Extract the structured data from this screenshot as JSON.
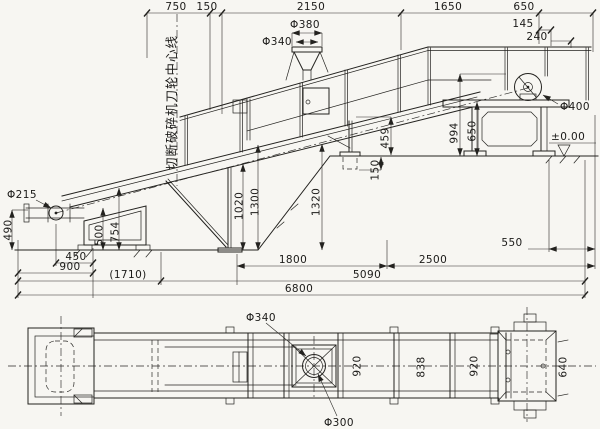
{
  "canvas": {
    "width": 600,
    "height": 429,
    "background": "#f7f6f2",
    "ink": "#23221f"
  },
  "elevation": {
    "note_crusher_centerline": "切断破碎机刀轮中心线",
    "top": {
      "d750": "750",
      "d150": "150",
      "d2150": "2150",
      "d1650": "1650",
      "d650": "650",
      "d145": "145",
      "d240": "240",
      "phi380": "Φ380",
      "phi340": "Φ340"
    },
    "right": {
      "phi400": "Φ400",
      "d994": "994",
      "d650": "650",
      "level": "±0.00",
      "d459": "459",
      "d150": "150"
    },
    "middle": {
      "d1320": "1320",
      "d1020": "1020",
      "d1300": "1300"
    },
    "left": {
      "phi215": "Φ215",
      "d490": "490",
      "d500": "500",
      "d754": "754"
    },
    "bottom": {
      "d450": "450",
      "d900": "900",
      "d1710": "(1710)",
      "d1800": "1800",
      "d2500": "2500",
      "d550": "550",
      "d5090": "5090",
      "d6800": "6800"
    }
  },
  "plan": {
    "phi340": "Φ340",
    "phi300": "Φ300",
    "d920_left": "920",
    "d838": "838",
    "d920_right": "920",
    "d640": "640"
  }
}
